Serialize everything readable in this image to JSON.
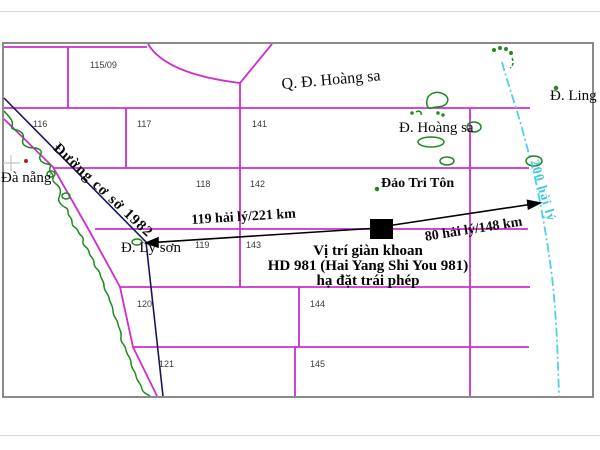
{
  "map": {
    "place_labels": {
      "paracel_group": "Q. Đ. Hoàng sa",
      "hoang_sa_island": "Đ. Hoàng sa",
      "ling_island": "Đ. Ling",
      "tri_ton_island": "Đảo Tri Tôn",
      "da_nang": "Đà nẵng",
      "ly_son_island": "Đ. Lý sơn"
    },
    "line_labels": {
      "baseline_1982": "Đường cơ sở 1982",
      "eez_200nm": "200 hải lý",
      "distance_to_ly_son": "119 hải lý/221 km",
      "distance_to_eez": "80 hải lý/148 km"
    },
    "rig_caption": {
      "line1": "Vị trí giàn khoan",
      "line2": "HD 981 (Hai Yang Shi You 981)",
      "line3": "hạ đặt trái phép"
    },
    "block_numbers": [
      "115/09",
      "116",
      "117",
      "141",
      "118",
      "142",
      "119",
      "143",
      "120",
      "144",
      "121",
      "145"
    ],
    "colors": {
      "grid_magenta": "#cc2fcc",
      "coastline_green": "#1c8a1c",
      "baseline_navy": "#16165e",
      "eez_cyan": "#4fd0e4",
      "frame_gray": "#8a8a8a",
      "rig_marker_black": "#000000",
      "da_nang_dot_red": "#b22020"
    }
  }
}
